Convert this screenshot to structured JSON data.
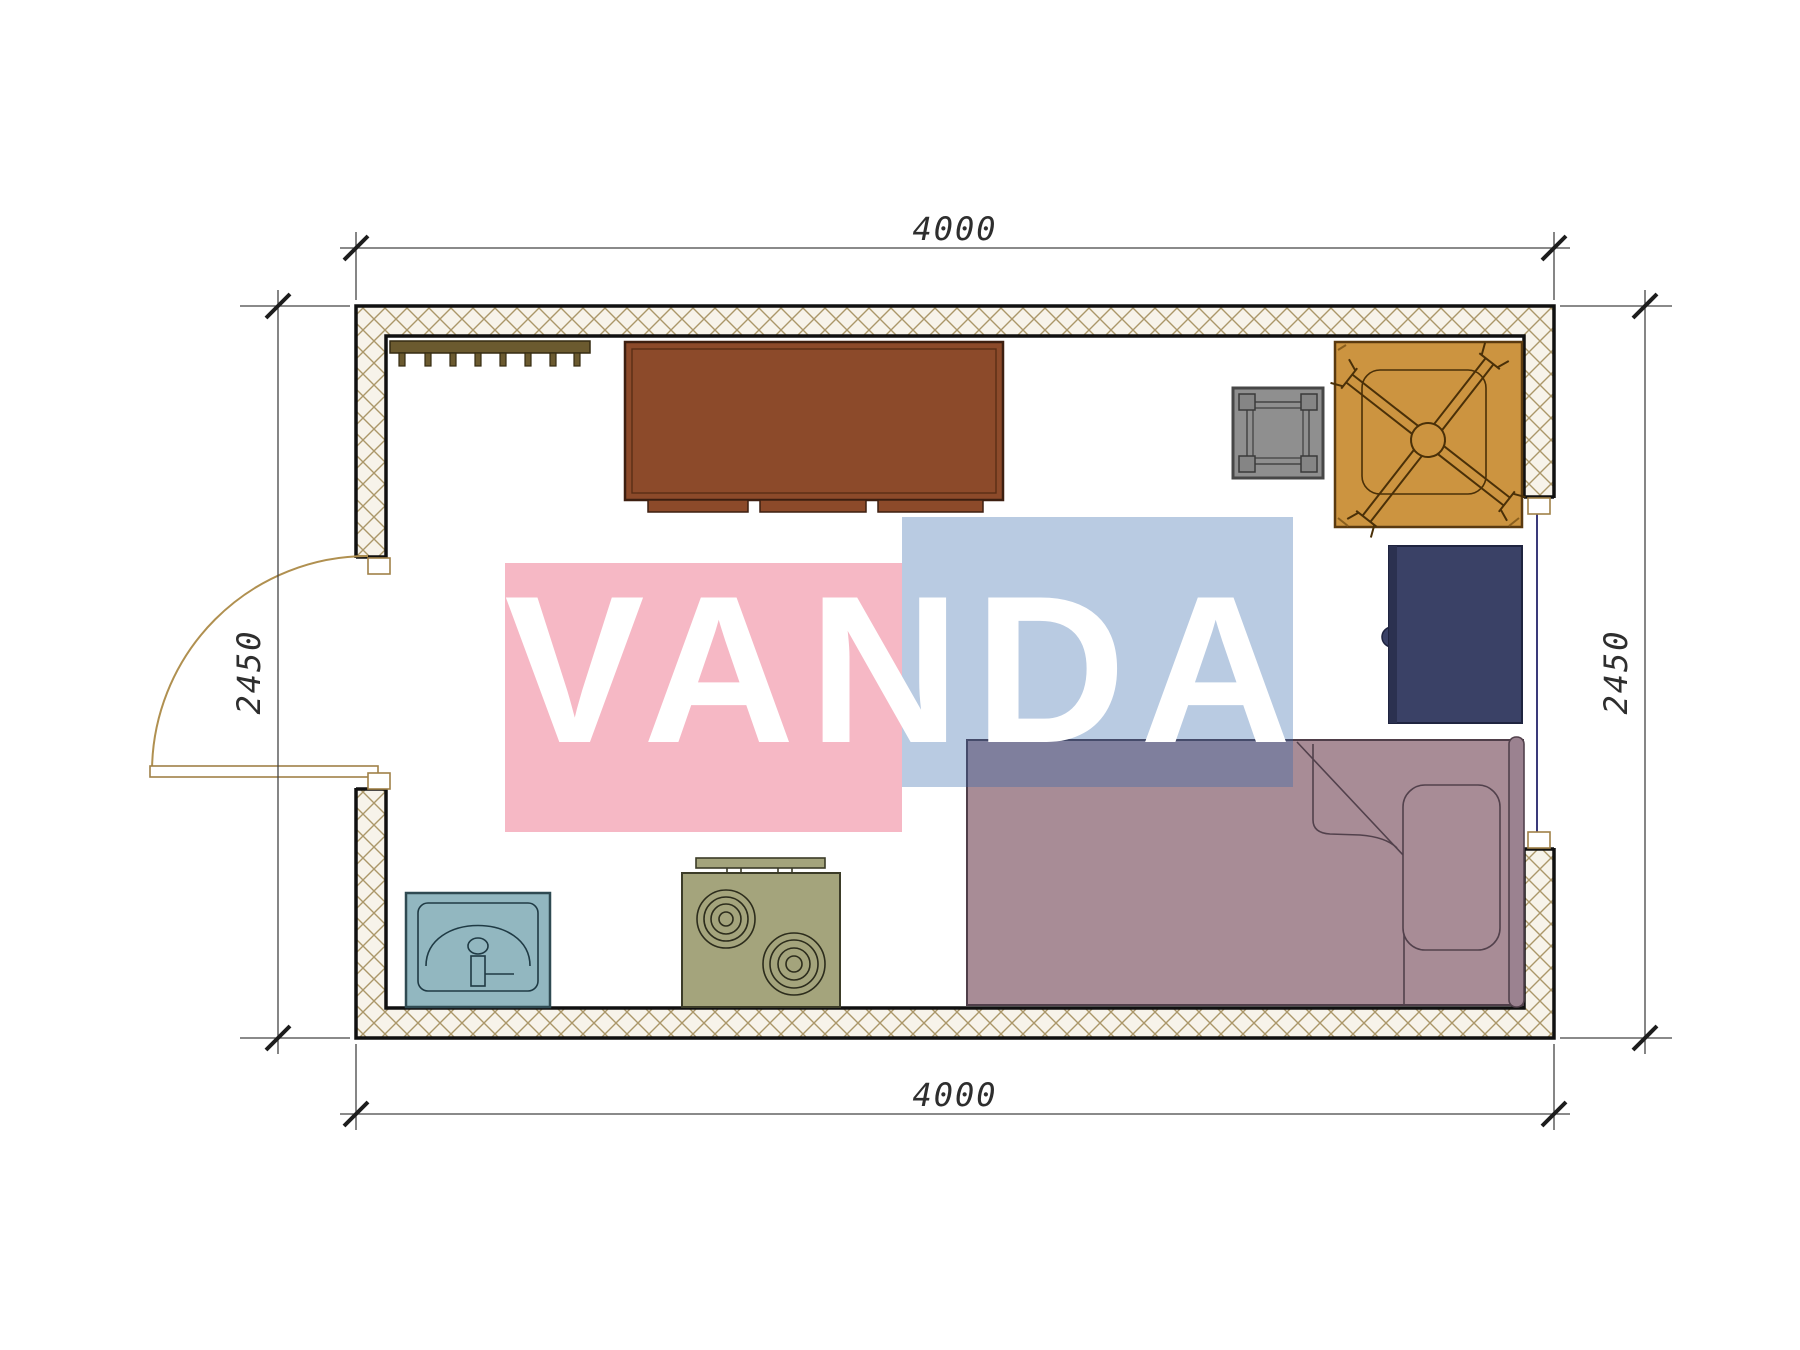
{
  "page": {
    "background": "#ffffff"
  },
  "plan": {
    "title": "single-room floor plan",
    "dimensions": {
      "top": "4000",
      "bottom": "4000",
      "left": "2450",
      "right": "2450"
    },
    "wall": {
      "fill": "#f7f3ea",
      "hatch_color": "#ab9769",
      "outline": "#101010"
    },
    "openings": [
      {
        "name": "door",
        "side": "left",
        "swing": "outward-arc"
      },
      {
        "name": "window",
        "side": "right",
        "glass_color": "#3a3a7a"
      }
    ],
    "furniture": [
      {
        "name": "coat-rack",
        "color": "#6b5a2f"
      },
      {
        "name": "wardrobe",
        "color": "#8c4a2a"
      },
      {
        "name": "stool",
        "color": "#8f8f8f"
      },
      {
        "name": "table-with-chair",
        "color": "#cc9440"
      },
      {
        "name": "cabinet",
        "color": "#3a4166"
      },
      {
        "name": "bed",
        "color": "#a88c96"
      },
      {
        "name": "sink",
        "color": "#92b7c0"
      },
      {
        "name": "stove",
        "color": "#a4a47c"
      }
    ]
  },
  "watermark": {
    "text": "VANDA",
    "pink": "#f6b8c5",
    "blue": "#b9cbe2",
    "letter_color": "#ffffff"
  }
}
